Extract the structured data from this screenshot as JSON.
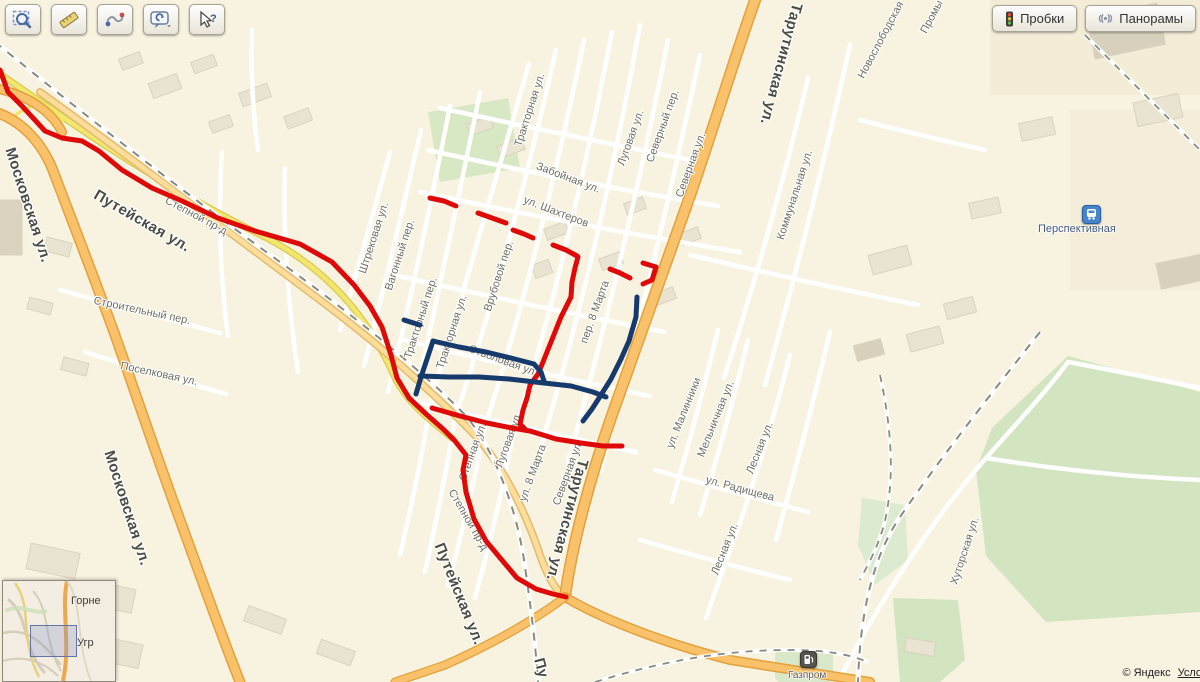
{
  "controls": {
    "traffic_label": "Пробки",
    "panoramas_label": "Панорамы"
  },
  "toolbar": {
    "buttons": [
      {
        "icon": "magnifier-select-icon"
      },
      {
        "icon": "ruler-icon"
      },
      {
        "icon": "route-curve-icon"
      },
      {
        "icon": "feedback-bubble-icon"
      },
      {
        "icon": "cursor-question-icon"
      }
    ]
  },
  "attribution": {
    "copyright": "© Яндекс",
    "terms_link": "Услови"
  },
  "minimap": {
    "labels": [
      {
        "text": "Горне"
      },
      {
        "text": "Угр"
      }
    ]
  },
  "pois": [
    {
      "name": "railway-station",
      "label": "Перспективная"
    },
    {
      "name": "fuel-station",
      "label": "Газпром"
    }
  ],
  "street_labels": [
    {
      "t": "Московская ул.",
      "x": 28,
      "y": 205,
      "r": 72,
      "s": 15,
      "c": "major"
    },
    {
      "t": "Московская ул.",
      "x": 127,
      "y": 508,
      "r": 72,
      "s": 15,
      "c": "major"
    },
    {
      "t": "Путейская ул.",
      "x": 142,
      "y": 221,
      "r": 30,
      "s": 15,
      "c": "major"
    },
    {
      "t": "Путейская ул.",
      "x": 459,
      "y": 594,
      "r": 68,
      "s": 15,
      "c": "major"
    },
    {
      "t": "Тарутинская ул.",
      "x": 781,
      "y": 64,
      "r": 105,
      "s": 15,
      "c": "major"
    },
    {
      "t": "Тарутинская ул.",
      "x": 567,
      "y": 520,
      "r": 105,
      "s": 15,
      "c": "major"
    },
    {
      "t": "Пу",
      "x": 541,
      "y": 668,
      "r": 75,
      "s": 15,
      "c": "major"
    },
    {
      "t": "Штрековая ул.",
      "x": 374,
      "y": 238,
      "r": -72,
      "s": 11
    },
    {
      "t": "Вагонный пер.",
      "x": 400,
      "y": 255,
      "r": -72,
      "s": 11
    },
    {
      "t": "Тракторный пер.",
      "x": 421,
      "y": 318,
      "r": -72,
      "s": 11
    },
    {
      "t": "Тракторная ул.",
      "x": 452,
      "y": 332,
      "r": -72,
      "s": 11
    },
    {
      "t": "Тракторная ул.",
      "x": 530,
      "y": 110,
      "r": -72,
      "s": 11
    },
    {
      "t": "Врубовой пер.",
      "x": 499,
      "y": 276,
      "r": -72,
      "s": 11
    },
    {
      "t": "Забойная ул.",
      "x": 568,
      "y": 178,
      "r": 21,
      "s": 11
    },
    {
      "t": "ул. Шахтеров",
      "x": 556,
      "y": 212,
      "r": 21,
      "s": 11
    },
    {
      "t": "Стволовая ул.",
      "x": 503,
      "y": 361,
      "r": 20,
      "s": 11
    },
    {
      "t": "Луговая ул.",
      "x": 631,
      "y": 138,
      "r": -70,
      "s": 11
    },
    {
      "t": "Северный пер.",
      "x": 663,
      "y": 126,
      "r": -70,
      "s": 11
    },
    {
      "t": "Северная ул.",
      "x": 691,
      "y": 165,
      "r": -70,
      "s": 11
    },
    {
      "t": "Коммунальная ул.",
      "x": 795,
      "y": 195,
      "r": -72,
      "s": 11
    },
    {
      "t": "Новослободская",
      "x": 881,
      "y": 40,
      "r": -62,
      "s": 11
    },
    {
      "t": "Промы",
      "x": 932,
      "y": 17,
      "r": -62,
      "s": 11
    },
    {
      "t": "пер. 8 Марта",
      "x": 595,
      "y": 312,
      "r": -70,
      "s": 11
    },
    {
      "t": "ул. 8 Марта",
      "x": 533,
      "y": 473,
      "r": -70,
      "s": 11
    },
    {
      "t": "Северная ул.",
      "x": 568,
      "y": 473,
      "r": -70,
      "s": 11
    },
    {
      "t": "Луговая ул.",
      "x": 509,
      "y": 440,
      "r": -70,
      "s": 11
    },
    {
      "t": "Степная ул.",
      "x": 473,
      "y": 452,
      "r": -70,
      "s": 11
    },
    {
      "t": "Степной пр-д",
      "x": 196,
      "y": 216,
      "r": 28,
      "s": 11
    },
    {
      "t": "Степной пр-д",
      "x": 468,
      "y": 520,
      "r": 60,
      "s": 11
    },
    {
      "t": "Строительный пер.",
      "x": 142,
      "y": 311,
      "r": 12,
      "s": 11
    },
    {
      "t": "Поселковая ул.",
      "x": 159,
      "y": 374,
      "r": 12,
      "s": 11
    },
    {
      "t": "ул. Малинники",
      "x": 684,
      "y": 413,
      "r": -68,
      "s": 11
    },
    {
      "t": "Мельничная ул.",
      "x": 716,
      "y": 419,
      "r": -68,
      "s": 11
    },
    {
      "t": "Лесная ул.",
      "x": 760,
      "y": 448,
      "r": -68,
      "s": 11
    },
    {
      "t": "Лесная ул.",
      "x": 725,
      "y": 549,
      "r": -68,
      "s": 11
    },
    {
      "t": "ул. Радищева",
      "x": 740,
      "y": 489,
      "r": 15,
      "s": 11
    },
    {
      "t": "Хуторская ул.",
      "x": 965,
      "y": 551,
      "r": -72,
      "s": 11
    }
  ],
  "routes": {
    "red_color": "#de0a0a",
    "blue_color": "#173a6d",
    "red": [
      [
        [
          0,
          70
        ],
        [
          8,
          92
        ],
        [
          22,
          106
        ],
        [
          45,
          131
        ],
        [
          62,
          138
        ],
        [
          82,
          141
        ],
        [
          99,
          151
        ],
        [
          122,
          170
        ],
        [
          152,
          188
        ],
        [
          182,
          201
        ],
        [
          218,
          218
        ],
        [
          255,
          231
        ],
        [
          300,
          244
        ],
        [
          332,
          262
        ],
        [
          354,
          285
        ],
        [
          370,
          306
        ],
        [
          382,
          327
        ],
        [
          391,
          355
        ],
        [
          397,
          378
        ],
        [
          409,
          398
        ],
        [
          426,
          414
        ],
        [
          443,
          429
        ],
        [
          455,
          441
        ],
        [
          466,
          455
        ],
        [
          463,
          470
        ],
        [
          466,
          492
        ],
        [
          474,
          519
        ],
        [
          486,
          541
        ],
        [
          501,
          559
        ],
        [
          517,
          578
        ],
        [
          536,
          589
        ],
        [
          553,
          594
        ],
        [
          566,
          597
        ]
      ],
      [
        [
          432,
          408
        ],
        [
          460,
          416
        ],
        [
          487,
          423
        ],
        [
          512,
          428
        ],
        [
          530,
          431
        ],
        [
          556,
          439
        ],
        [
          581,
          443
        ],
        [
          603,
          446
        ],
        [
          622,
          446
        ]
      ],
      [
        [
          578,
          257
        ],
        [
          575,
          268
        ],
        [
          572,
          282
        ],
        [
          571,
          297
        ],
        [
          561,
          317
        ],
        [
          551,
          342
        ],
        [
          543,
          362
        ],
        [
          538,
          374
        ],
        [
          530,
          385
        ],
        [
          527,
          398
        ],
        [
          523,
          410
        ],
        [
          520,
          424
        ],
        [
          525,
          429
        ]
      ],
      [
        [
          430,
          198
        ],
        [
          444,
          201
        ],
        [
          456,
          206
        ]
      ],
      [
        [
          478,
          213
        ],
        [
          492,
          218
        ],
        [
          506,
          223
        ]
      ],
      [
        [
          513,
          230
        ],
        [
          524,
          234
        ],
        [
          533,
          238
        ]
      ],
      [
        [
          553,
          245
        ],
        [
          566,
          250
        ],
        [
          577,
          256
        ]
      ],
      [
        [
          610,
          269
        ],
        [
          620,
          273
        ],
        [
          630,
          278
        ]
      ],
      [
        [
          643,
          263
        ],
        [
          656,
          267
        ],
        [
          652,
          280
        ],
        [
          643,
          284
        ]
      ]
    ],
    "blue": [
      [
        [
          404,
          320
        ],
        [
          420,
          325
        ]
      ],
      [
        [
          433,
          341
        ],
        [
          427,
          359
        ],
        [
          421,
          377
        ],
        [
          416,
          394
        ]
      ],
      [
        [
          433,
          341
        ],
        [
          459,
          347
        ],
        [
          486,
          352
        ],
        [
          511,
          358
        ],
        [
          534,
          364
        ],
        [
          541,
          372
        ],
        [
          544,
          381
        ]
      ],
      [
        [
          420,
          376
        ],
        [
          449,
          377
        ],
        [
          479,
          377
        ],
        [
          509,
          379
        ],
        [
          544,
          383
        ],
        [
          571,
          386
        ],
        [
          593,
          392
        ],
        [
          606,
          397
        ]
      ],
      [
        [
          637,
          297
        ],
        [
          636,
          317
        ],
        [
          629,
          341
        ],
        [
          621,
          359
        ],
        [
          611,
          379
        ],
        [
          601,
          395
        ],
        [
          592,
          409
        ],
        [
          583,
          421
        ]
      ]
    ]
  }
}
